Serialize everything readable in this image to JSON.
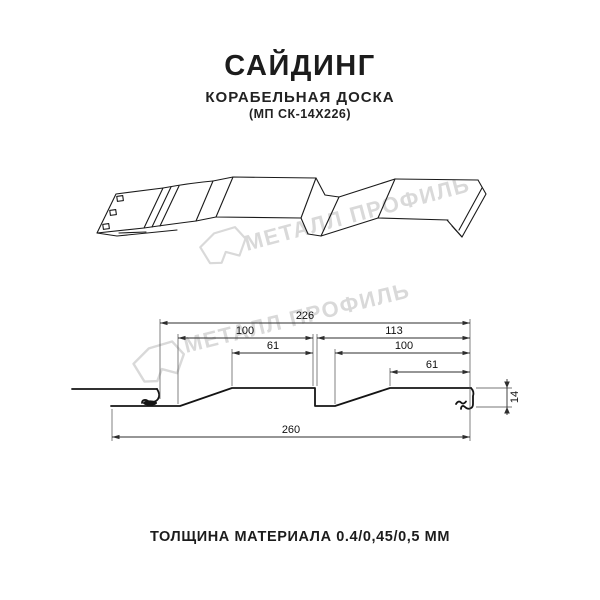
{
  "header": {
    "title": "САЙДИНГ",
    "subtitle": "КОРАБЕЛЬНАЯ ДОСКА",
    "code": "(МП СК-14Х226)"
  },
  "footer": {
    "thickness_note": "ТОЛЩИНА МАТЕРИАЛА 0.4/0,45/0,5 ММ"
  },
  "watermark": {
    "brand": "МЕТАЛЛ ПРОФИЛЬ",
    "color": "#d9d9d9"
  },
  "drawing": {
    "kind": "technical cross-section with 3d view",
    "dimensions": {
      "d226": "226",
      "d100_left": "100",
      "d113": "113",
      "d61_left": "61",
      "d100_right": "100",
      "d61_right": "61",
      "d14": "14",
      "d260": "260"
    }
  },
  "colors": {
    "background": "#ffffff",
    "line": "#1a1a1a",
    "dimension": "#2e2e2e",
    "watermark": "#d9d9d9"
  }
}
